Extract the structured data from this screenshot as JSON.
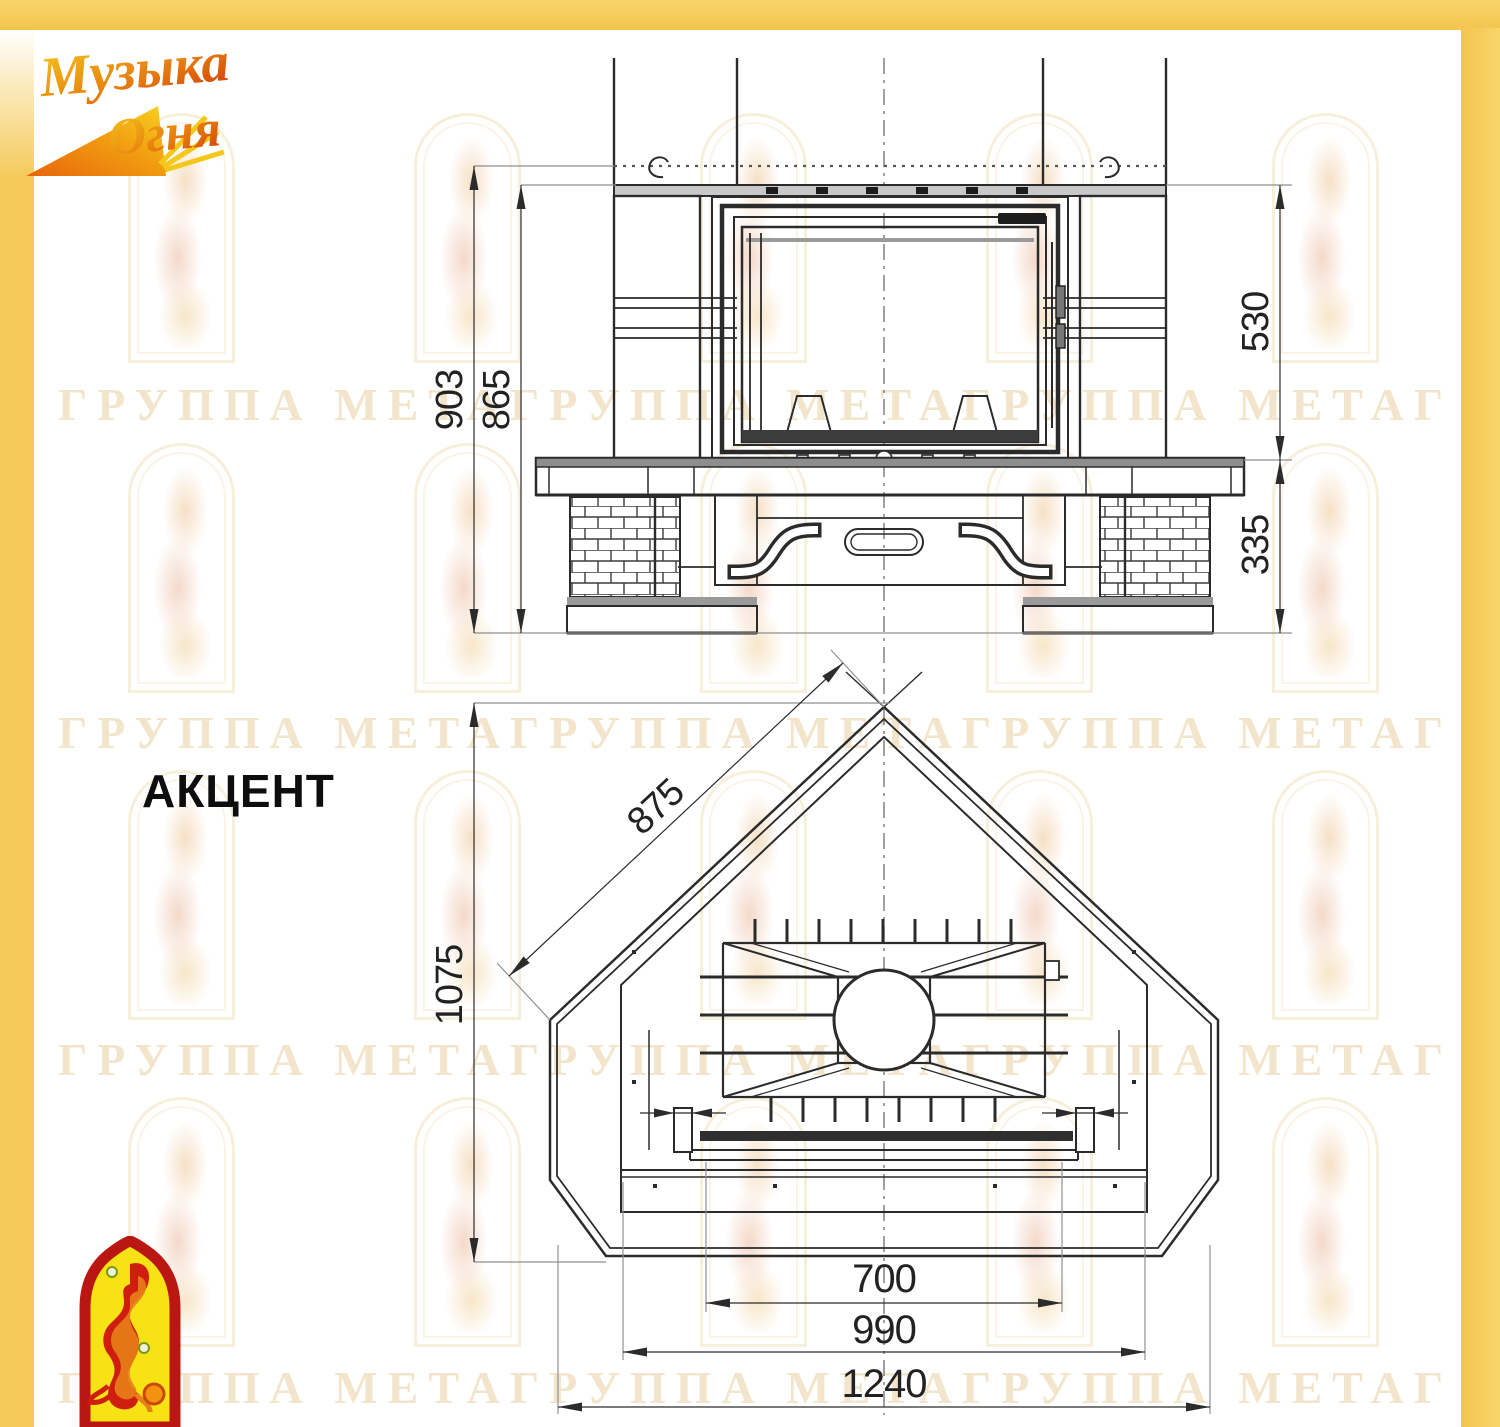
{
  "model": {
    "name": "АКЦЕНТ"
  },
  "brand": {
    "logo_line1": "Музыка",
    "logo_line2": "Огня"
  },
  "watermark": {
    "row_text": "ГРУППА МЕТАГРУППА МЕТАГРУППА МЕТАГРУППА МЕТАГРУППА МЕТА"
  },
  "front_view": {
    "dim_overall_height": "903",
    "dim_body_height": "865",
    "dim_firebox_height": "530",
    "dim_base_height": "335"
  },
  "plan_view": {
    "dim_diagonal": "875",
    "dim_depth": "1075",
    "dim_front_width": "700",
    "dim_mid_width": "990",
    "dim_overall_width": "1240"
  },
  "colors": {
    "frame_yellow": "#f5ca5a",
    "logo_red": "#bb1712",
    "logo_yellow": "#f6e215",
    "line": "#2b2b2b"
  }
}
